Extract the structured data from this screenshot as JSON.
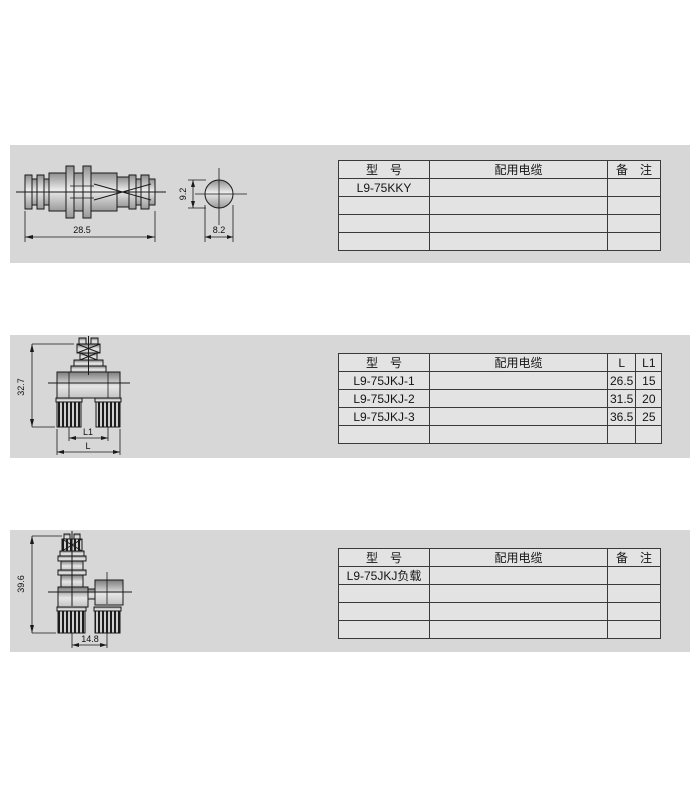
{
  "page": {
    "background": "#ffffff",
    "panel_bg": "#d7d7d7",
    "table_bg": "#e3e3e3",
    "line_color": "#1a1a1a"
  },
  "sections": [
    {
      "id": "adapter",
      "drawing": {
        "length_dim": "28.5",
        "side_height_dim": "9.2",
        "side_width_dim": "8.2"
      },
      "table": {
        "headers": [
          "型　号",
          "配用电缆",
          "备　注"
        ],
        "rows": [
          [
            "L9-75KKY",
            "",
            ""
          ],
          [
            "",
            "",
            ""
          ],
          [
            "",
            "",
            ""
          ],
          [
            "",
            "",
            ""
          ]
        ]
      }
    },
    {
      "id": "tee-jack",
      "drawing": {
        "height_dim": "32.7",
        "inner_width_dim": "L1",
        "outer_width_dim": "L"
      },
      "table": {
        "headers": [
          "型　号",
          "配用电缆",
          "L",
          "L1"
        ],
        "rows": [
          [
            "L9-75JKJ-1",
            "",
            "26.5",
            "15"
          ],
          [
            "L9-75JKJ-2",
            "",
            "31.5",
            "20"
          ],
          [
            "L9-75JKJ-3",
            "",
            "36.5",
            "25"
          ],
          [
            "",
            "",
            "",
            ""
          ]
        ]
      }
    },
    {
      "id": "load",
      "drawing": {
        "height_dim": "39.6",
        "width_dim": "14.8"
      },
      "table": {
        "headers": [
          "型　号",
          "配用电缆",
          "备　注"
        ],
        "rows": [
          [
            "L9-75JKJ负载",
            "",
            ""
          ],
          [
            "",
            "",
            ""
          ],
          [
            "",
            "",
            ""
          ],
          [
            "",
            "",
            ""
          ]
        ]
      }
    }
  ]
}
